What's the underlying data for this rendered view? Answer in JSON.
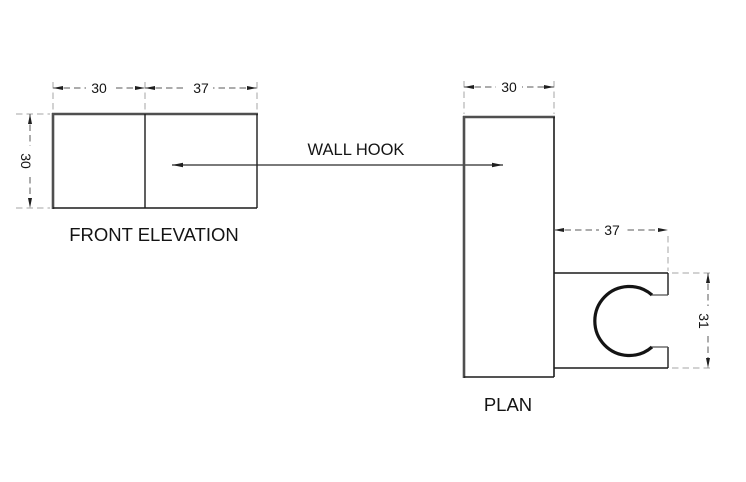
{
  "callout": {
    "label": "WALL HOOK"
  },
  "views": {
    "front_elevation": {
      "label": "FRONT ELEVATION",
      "dims": {
        "width_left": "30",
        "width_right": "37",
        "height": "30"
      }
    },
    "plan": {
      "label": "PLAN",
      "dims": {
        "width": "30",
        "hook_depth": "37",
        "hook_height": "31"
      }
    }
  },
  "colors": {
    "object_line": "#1c1c1c",
    "object_line_thick": "#4f4f4f",
    "dimension_line": "#595959",
    "extension_line": "#a6a6a6",
    "text": "#141414",
    "background": "#ffffff"
  }
}
